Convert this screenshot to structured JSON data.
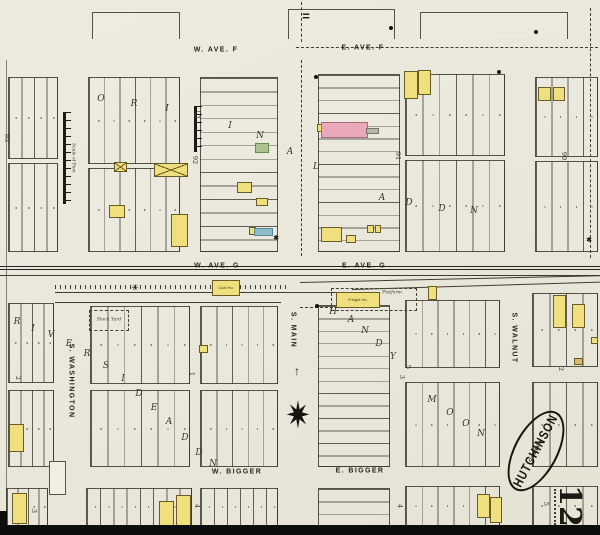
{
  "sheet": {
    "city": "HUTCHINSON",
    "state": "KAN.",
    "date": "Oct. 1888",
    "number": "12"
  },
  "scale_bar_label": "Scale of Feet",
  "street_labels": [
    {
      "id": "w-ave-f",
      "text": "W. AVE. F",
      "x": 216,
      "y": 50,
      "rot": 0
    },
    {
      "id": "e-ave-f",
      "text": "E. AVE. F",
      "x": 363,
      "y": 48,
      "rot": 0
    },
    {
      "id": "w-ave-g",
      "text": "W. AVE. G",
      "x": 217,
      "y": 266,
      "rot": 0
    },
    {
      "id": "e-ave-g",
      "text": "E. AVE. G",
      "x": 364,
      "y": 266,
      "rot": 0
    },
    {
      "id": "w-bigger",
      "text": "W. BIGGER",
      "x": 237,
      "y": 472,
      "rot": 0
    },
    {
      "id": "e-bigger",
      "text": "E. BIGGER",
      "x": 360,
      "y": 471,
      "rot": 0
    },
    {
      "id": "s-washington",
      "text": "S. WASHINGTON",
      "x": 71,
      "y": 381,
      "rot": 90
    },
    {
      "id": "s-main",
      "text": "S. MAIN",
      "x": 293,
      "y": 330,
      "rot": 90
    },
    {
      "id": "s-walnut",
      "text": "S. WALNUT",
      "x": 514,
      "y": 338,
      "rot": 90
    }
  ],
  "block_numbers": [
    {
      "t": "93",
      "x": 7,
      "y": 138
    },
    {
      "t": "92",
      "x": 195,
      "y": 160
    },
    {
      "t": "91",
      "x": 398,
      "y": 156
    },
    {
      "t": "90",
      "x": 564,
      "y": 156
    },
    {
      "t": "2",
      "x": 18,
      "y": 378
    },
    {
      "t": "1",
      "x": 192,
      "y": 374
    },
    {
      "t": "5",
      "x": 408,
      "y": 367
    },
    {
      "t": "3",
      "x": 402,
      "y": 377
    },
    {
      "t": "2",
      "x": 561,
      "y": 369
    },
    {
      "t": "3",
      "x": 34,
      "y": 511
    },
    {
      "t": "4",
      "x": 197,
      "y": 506
    },
    {
      "t": "4",
      "x": 400,
      "y": 506
    },
    {
      "t": "5",
      "x": 546,
      "y": 504
    }
  ],
  "addition_letters": [
    {
      "t": "O",
      "x": 101,
      "y": 99
    },
    {
      "t": "R",
      "x": 134,
      "y": 104
    },
    {
      "t": "I",
      "x": 167,
      "y": 109
    },
    {
      "t": "G",
      "x": 198,
      "y": 116
    },
    {
      "t": "I",
      "x": 230,
      "y": 126
    },
    {
      "t": "N",
      "x": 260,
      "y": 136
    },
    {
      "t": "A",
      "x": 290,
      "y": 152
    },
    {
      "t": "L",
      "x": 316,
      "y": 167
    },
    {
      "t": "A",
      "x": 382,
      "y": 198
    },
    {
      "t": "D",
      "x": 409,
      "y": 203
    },
    {
      "t": "D",
      "x": 442,
      "y": 209
    },
    {
      "t": "N",
      "x": 474,
      "y": 211
    },
    {
      "t": "R",
      "x": 17,
      "y": 322
    },
    {
      "t": "I",
      "x": 33,
      "y": 329
    },
    {
      "t": "V",
      "x": 51,
      "y": 335
    },
    {
      "t": "E",
      "x": 69,
      "y": 344
    },
    {
      "t": "R",
      "x": 87,
      "y": 354
    },
    {
      "t": "S",
      "x": 106,
      "y": 366
    },
    {
      "t": "I",
      "x": 123,
      "y": 379
    },
    {
      "t": "D",
      "x": 139,
      "y": 394
    },
    {
      "t": "E",
      "x": 154,
      "y": 408
    },
    {
      "t": "A",
      "x": 169,
      "y": 422
    },
    {
      "t": "D",
      "x": 185,
      "y": 438
    },
    {
      "t": "D",
      "x": 199,
      "y": 453
    },
    {
      "t": "N",
      "x": 213,
      "y": 464
    },
    {
      "t": "H",
      "x": 333,
      "y": 312
    },
    {
      "t": "A",
      "x": 351,
      "y": 320
    },
    {
      "t": "N",
      "x": 365,
      "y": 331
    },
    {
      "t": "D",
      "x": 379,
      "y": 344
    },
    {
      "t": "Y",
      "x": 393,
      "y": 357
    },
    {
      "t": "M",
      "x": 432,
      "y": 400
    },
    {
      "t": "O",
      "x": 450,
      "y": 413
    },
    {
      "t": "O",
      "x": 466,
      "y": 424
    },
    {
      "t": "N",
      "x": 481,
      "y": 434
    }
  ],
  "blocks": [
    {
      "x": 92,
      "y": 12,
      "w": 88,
      "h": 27,
      "dir": "v",
      "n": 0,
      "open": true
    },
    {
      "x": 288,
      "y": 9,
      "w": 107,
      "h": 30,
      "dir": "v",
      "n": 0,
      "open": true
    },
    {
      "x": 420,
      "y": 12,
      "w": 148,
      "h": 27,
      "dir": "v",
      "n": 0,
      "open": true
    },
    {
      "x": 8,
      "y": 77,
      "w": 50,
      "h": 82,
      "dir": "v",
      "n": 4
    },
    {
      "x": 8,
      "y": 163,
      "w": 50,
      "h": 89,
      "dir": "v",
      "n": 4
    },
    {
      "x": 88,
      "y": 77,
      "w": 92,
      "h": 87,
      "dir": "v",
      "n": 6
    },
    {
      "x": 88,
      "y": 168,
      "w": 92,
      "h": 84,
      "dir": "v",
      "n": 6
    },
    {
      "x": 200,
      "y": 77,
      "w": 78,
      "h": 175,
      "dir": "h",
      "n": 13
    },
    {
      "x": 318,
      "y": 74,
      "w": 82,
      "h": 178,
      "dir": "h",
      "n": 14
    },
    {
      "x": 405,
      "y": 74,
      "w": 100,
      "h": 82,
      "dir": "v",
      "n": 6
    },
    {
      "x": 405,
      "y": 160,
      "w": 100,
      "h": 92,
      "dir": "v",
      "n": 6
    },
    {
      "x": 535,
      "y": 77,
      "w": 63,
      "h": 80,
      "dir": "v",
      "n": 4
    },
    {
      "x": 535,
      "y": 161,
      "w": 63,
      "h": 91,
      "dir": "v",
      "n": 4
    },
    {
      "x": 8,
      "y": 303,
      "w": 46,
      "h": 80,
      "dir": "v",
      "n": 4
    },
    {
      "x": 8,
      "y": 390,
      "w": 46,
      "h": 77,
      "dir": "v",
      "n": 4
    },
    {
      "x": 6,
      "y": 488,
      "w": 42,
      "h": 38,
      "dir": "v",
      "n": 4
    },
    {
      "x": 90,
      "y": 306,
      "w": 100,
      "h": 78,
      "dir": "v",
      "n": 6
    },
    {
      "x": 200,
      "y": 306,
      "w": 78,
      "h": 78,
      "dir": "v",
      "n": 5
    },
    {
      "x": 90,
      "y": 390,
      "w": 100,
      "h": 77,
      "dir": "v",
      "n": 6
    },
    {
      "x": 200,
      "y": 390,
      "w": 78,
      "h": 77,
      "dir": "v",
      "n": 5
    },
    {
      "x": 86,
      "y": 488,
      "w": 106,
      "h": 38,
      "dir": "v",
      "n": 8
    },
    {
      "x": 200,
      "y": 488,
      "w": 78,
      "h": 38,
      "dir": "v",
      "n": 6
    },
    {
      "x": 318,
      "y": 305,
      "w": 72,
      "h": 162,
      "dir": "h",
      "n": 13
    },
    {
      "x": 318,
      "y": 488,
      "w": 72,
      "h": 38,
      "dir": "h",
      "n": 3
    },
    {
      "x": 405,
      "y": 300,
      "w": 95,
      "h": 68,
      "dir": "v",
      "n": 6
    },
    {
      "x": 405,
      "y": 382,
      "w": 95,
      "h": 85,
      "dir": "v",
      "n": 6
    },
    {
      "x": 405,
      "y": 486,
      "w": 95,
      "h": 40,
      "dir": "v",
      "n": 6
    },
    {
      "x": 532,
      "y": 293,
      "w": 66,
      "h": 74,
      "dir": "v",
      "n": 4
    },
    {
      "x": 532,
      "y": 382,
      "w": 66,
      "h": 85,
      "dir": "v",
      "n": 4
    },
    {
      "x": 532,
      "y": 486,
      "w": 66,
      "h": 40,
      "dir": "v",
      "n": 4
    }
  ],
  "buildings": [
    {
      "x": 114,
      "y": 162,
      "w": 13,
      "h": 10,
      "c": "y",
      "cross": true
    },
    {
      "x": 154,
      "y": 163,
      "w": 34,
      "h": 14,
      "c": "y",
      "cross": true
    },
    {
      "x": 109,
      "y": 205,
      "w": 16,
      "h": 13,
      "c": "y"
    },
    {
      "x": 171,
      "y": 214,
      "w": 17,
      "h": 33,
      "c": "y"
    },
    {
      "x": 237,
      "y": 182,
      "w": 15,
      "h": 11,
      "c": "y"
    },
    {
      "x": 256,
      "y": 198,
      "w": 12,
      "h": 8,
      "c": "y"
    },
    {
      "x": 255,
      "y": 143,
      "w": 14,
      "h": 10,
      "c": "g"
    },
    {
      "x": 249,
      "y": 227,
      "w": 7,
      "h": 8,
      "c": "y"
    },
    {
      "x": 254,
      "y": 228,
      "w": 19,
      "h": 8,
      "c": "b"
    },
    {
      "x": 317,
      "y": 124,
      "w": 6,
      "h": 8,
      "c": "y"
    },
    {
      "x": 321,
      "y": 122,
      "w": 47,
      "h": 16,
      "c": "p"
    },
    {
      "x": 366,
      "y": 128,
      "w": 13,
      "h": 6,
      "c": "gray"
    },
    {
      "x": 321,
      "y": 227,
      "w": 21,
      "h": 15,
      "c": "y"
    },
    {
      "x": 346,
      "y": 235,
      "w": 10,
      "h": 8,
      "c": "y"
    },
    {
      "x": 367,
      "y": 225,
      "w": 7,
      "h": 8,
      "c": "y"
    },
    {
      "x": 375,
      "y": 225,
      "w": 6,
      "h": 8,
      "c": "y"
    },
    {
      "x": 404,
      "y": 71,
      "w": 14,
      "h": 28,
      "c": "y"
    },
    {
      "x": 418,
      "y": 70,
      "w": 13,
      "h": 25,
      "c": "y"
    },
    {
      "x": 538,
      "y": 87,
      "w": 13,
      "h": 14,
      "c": "y"
    },
    {
      "x": 553,
      "y": 87,
      "w": 12,
      "h": 14,
      "c": "y"
    },
    {
      "x": 212,
      "y": 280,
      "w": 28,
      "h": 16,
      "c": "y",
      "label": "Coal Ho."
    },
    {
      "x": 336,
      "y": 292,
      "w": 44,
      "h": 16,
      "c": "y",
      "label": "Freight Ho."
    },
    {
      "x": 428,
      "y": 286,
      "w": 9,
      "h": 14,
      "c": "y"
    },
    {
      "x": 9,
      "y": 424,
      "w": 15,
      "h": 28,
      "c": "y"
    },
    {
      "x": 49,
      "y": 461,
      "w": 17,
      "h": 34,
      "c": "w"
    },
    {
      "x": 199,
      "y": 345,
      "w": 9,
      "h": 8,
      "c": "y"
    },
    {
      "x": 12,
      "y": 493,
      "w": 15,
      "h": 31,
      "c": "y"
    },
    {
      "x": 159,
      "y": 501,
      "w": 15,
      "h": 30,
      "c": "y"
    },
    {
      "x": 176,
      "y": 495,
      "w": 15,
      "h": 36,
      "c": "y"
    },
    {
      "x": 553,
      "y": 295,
      "w": 13,
      "h": 33,
      "c": "y"
    },
    {
      "x": 572,
      "y": 304,
      "w": 13,
      "h": 24,
      "c": "y"
    },
    {
      "x": 574,
      "y": 358,
      "w": 9,
      "h": 7,
      "c": "o"
    },
    {
      "x": 591,
      "y": 337,
      "w": 7,
      "h": 7,
      "c": "y"
    },
    {
      "x": 477,
      "y": 494,
      "w": 13,
      "h": 24,
      "c": "y"
    },
    {
      "x": 490,
      "y": 497,
      "w": 12,
      "h": 26,
      "c": "y"
    }
  ],
  "tiny_labels": [
    {
      "t": "Stock Yard",
      "x": 109,
      "y": 320
    },
    {
      "t": "Platform",
      "x": 392,
      "y": 293
    }
  ],
  "lines": [
    {
      "type": "dh",
      "x": 296,
      "y": 47,
      "w": 302
    },
    {
      "type": "dv",
      "x": 301,
      "y": 2,
      "h": 40
    },
    {
      "type": "dv",
      "x": 301,
      "y": 60,
      "h": 196
    },
    {
      "type": "dv",
      "x": 590,
      "y": 8,
      "h": 250
    },
    {
      "type": "rr",
      "x": 0,
      "y": 266,
      "w": 600
    },
    {
      "type": "sh",
      "x": 0,
      "y": 275,
      "w": 600
    },
    {
      "type": "sh",
      "x": 300,
      "y": 282,
      "w": 300,
      "rot": -1.3
    },
    {
      "type": "sh",
      "x": 352,
      "y": 289,
      "w": 248,
      "rot": -1.7
    },
    {
      "type": "sh",
      "x": 55,
      "y": 292,
      "w": 312
    },
    {
      "type": "hatch",
      "x": 55,
      "y": 285,
      "w": 232
    },
    {
      "type": "sh",
      "x": 55,
      "y": 302,
      "w": 226
    },
    {
      "type": "drect",
      "x": 331,
      "y": 288,
      "w": 86,
      "h": 23
    },
    {
      "type": "drect",
      "x": 89,
      "y": 310,
      "w": 40,
      "h": 21
    },
    {
      "type": "dh",
      "x": 300,
      "y": 307,
      "w": 58
    },
    {
      "type": "dotv",
      "x": 554,
      "y": 489,
      "h": 36
    },
    {
      "type": "sv",
      "x": 6,
      "y": 60,
      "h": 462
    }
  ],
  "symbols": {
    "bridge_mark": {
      "t": "=",
      "x": 306,
      "y": 16
    },
    "compass_rose": {
      "t": "✷",
      "x": 298,
      "y": 416
    },
    "north_arrow": {
      "t": "↑",
      "x": 297,
      "y": 371
    },
    "windmill": {
      "t": "✳",
      "x": 135,
      "y": 288
    },
    "dots": [
      {
        "x": 316,
        "y": 77
      },
      {
        "x": 499,
        "y": 72
      },
      {
        "x": 317,
        "y": 306
      },
      {
        "x": 536,
        "y": 32
      },
      {
        "x": 391,
        "y": 28
      }
    ],
    "stars": [
      {
        "x": 276,
        "y": 238
      },
      {
        "x": 589,
        "y": 240
      }
    ]
  },
  "scale_bars": [
    {
      "x": 63,
      "y": 112,
      "h": 92,
      "labeled": true
    },
    {
      "x": 194,
      "y": 106,
      "h": 46,
      "labeled": false
    }
  ]
}
